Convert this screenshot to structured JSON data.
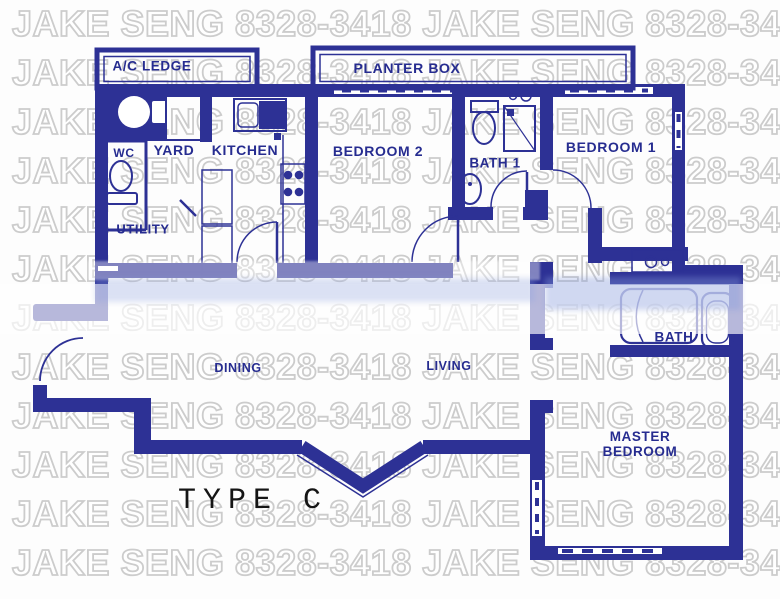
{
  "watermark": {
    "text": "JAKE SENG 8328-3418",
    "repeats_per_row": 2,
    "rows": 12
  },
  "palette": {
    "wall": "#2d3195",
    "label": "#262c90",
    "watermark_fill": "#ffffff",
    "watermark_outline": "#cccccc",
    "type_label_color": "#151515"
  },
  "plan": {
    "title": "TYPE C",
    "rooms": {
      "ac_ledge": "A/C LEDGE",
      "planter_box": "PLANTER BOX",
      "yard": "YARD",
      "kitchen": "KITCHEN",
      "wc": "WC",
      "utility": "UTILITY",
      "bedroom2": "BEDROOM 2",
      "bath1": "BATH 1",
      "bedroom1": "BEDROOM 1",
      "dining": "DINING",
      "living": "LIVING",
      "master_bath": "BATH",
      "master_line1": "MASTER",
      "master_line2": "BEDROOM"
    },
    "fixtures": [
      "washing-machine",
      "wc-toilet",
      "kitchen-sink",
      "stove",
      "yard-cabinet",
      "bath1-toilet",
      "bath1-shower",
      "bath1-sink",
      "bath1-basins",
      "vanity-basins",
      "master-bathtub",
      "master-toilet"
    ]
  }
}
